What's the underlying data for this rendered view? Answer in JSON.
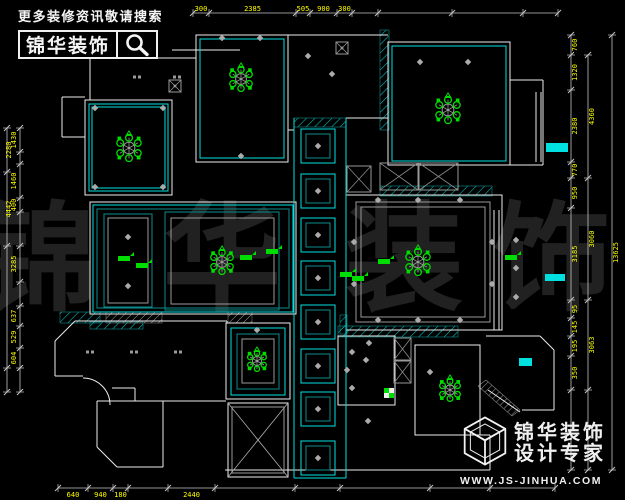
{
  "branding": {
    "top": {
      "tagline": "更多装修资讯敬请搜索",
      "logo_text": "锦华装饰",
      "icon": "magnifier-icon"
    },
    "bottom": {
      "line1": "锦华装饰",
      "line2": "设计专家",
      "url": "WWW.JS-JINHUA.COM",
      "icon": "cube-logo-icon"
    }
  },
  "watermark": {
    "chars": [
      "锦",
      "华",
      "装",
      "饰"
    ],
    "xs": [
      38,
      222,
      404,
      552
    ],
    "y": 300,
    "size": 118,
    "color": "#212121"
  },
  "plan": {
    "colors": {
      "wall": "#EDEDED",
      "cyan": "#00E0E0",
      "teal": "#0E8B8B",
      "gray": "#9A9A9A",
      "green": "#00DD00",
      "yellow": "#FFFF00",
      "dim": "#C6C6C6"
    },
    "walls": {
      "rects": [
        [
          85,
          100,
          87,
          95
        ],
        [
          196,
          35,
          92,
          127
        ],
        [
          388,
          42,
          122,
          123
        ],
        [
          90,
          202,
          206,
          112
        ],
        [
          346,
          195,
          156,
          135
        ],
        [
          226,
          323,
          64,
          76
        ],
        [
          415,
          345,
          65,
          90
        ],
        [
          338,
          336,
          57,
          69
        ]
      ],
      "lines": [
        [
          62,
          97,
          85,
          97
        ],
        [
          62,
          97,
          62,
          137
        ],
        [
          62,
          137,
          85,
          137
        ],
        [
          90,
          58,
          196,
          58
        ],
        [
          90,
          58,
          90,
          100
        ],
        [
          172,
          50,
          240,
          50
        ],
        [
          288,
          35,
          388,
          35
        ],
        [
          510,
          80,
          543,
          80
        ],
        [
          543,
          80,
          543,
          165
        ],
        [
          510,
          165,
          543,
          165
        ],
        [
          536,
          92,
          536,
          162
        ],
        [
          541,
          92,
          541,
          162
        ],
        [
          494,
          210,
          494,
          330
        ],
        [
          499,
          210,
          499,
          330
        ],
        [
          486,
          336,
          540,
          336
        ],
        [
          540,
          336,
          554,
          350
        ],
        [
          554,
          350,
          554,
          410
        ],
        [
          554,
          410,
          522,
          410
        ],
        [
          488,
          390,
          520,
          412
        ],
        [
          225,
          470,
          418,
          470
        ],
        [
          415,
          435,
          490,
          435
        ],
        [
          490,
          435,
          490,
          470
        ],
        [
          418,
          470,
          490,
          470
        ],
        [
          75,
          321,
          227,
          321
        ],
        [
          75,
          321,
          55,
          341
        ],
        [
          55,
          341,
          55,
          376
        ],
        [
          55,
          376,
          83,
          376
        ],
        [
          112,
          388,
          135,
          388
        ],
        [
          135,
          388,
          135,
          401
        ],
        [
          135,
          401,
          226,
          401
        ],
        [
          227,
          321,
          227,
          323
        ],
        [
          97,
          401,
          163,
          401
        ],
        [
          163,
          401,
          163,
          467
        ],
        [
          163,
          467,
          117,
          467
        ],
        [
          117,
          467,
          97,
          447
        ],
        [
          97,
          447,
          97,
          401
        ],
        [
          346,
          118,
          388,
          118
        ],
        [
          288,
          130,
          294,
          130
        ]
      ]
    },
    "arcs": [
      "M83,378 A27,27 0 0 1 110,405"
    ],
    "cyanLines": [
      [
        294,
        118,
        294,
        478
      ],
      [
        346,
        118,
        346,
        478
      ],
      [
        294,
        478,
        346,
        478
      ]
    ],
    "cyanRects": [
      [
        89,
        104,
        79,
        87
      ],
      [
        92,
        107,
        73,
        81
      ],
      [
        200,
        39,
        84,
        119
      ],
      [
        392,
        46,
        114,
        115
      ],
      [
        93,
        205,
        200,
        107
      ],
      [
        231,
        328,
        54,
        67
      ]
    ],
    "tealRects": [
      [
        97,
        209,
        192,
        99
      ],
      [
        104,
        214,
        48,
        93
      ],
      [
        165,
        212,
        114,
        98
      ],
      [
        237,
        334,
        42,
        55
      ]
    ],
    "grayRects": [
      [
        108,
        218,
        40,
        85
      ],
      [
        171,
        218,
        103,
        86
      ],
      [
        356,
        202,
        134,
        120
      ],
      [
        361,
        207,
        124,
        110
      ],
      [
        242,
        339,
        32,
        44
      ],
      [
        232,
        407,
        52,
        66
      ]
    ],
    "hatchesCyan": [
      [
        294,
        118,
        52,
        9
      ],
      [
        380,
        30,
        9,
        100
      ],
      [
        380,
        186,
        112,
        10
      ],
      [
        90,
        322,
        53,
        7
      ],
      [
        60,
        312,
        40,
        11
      ],
      [
        338,
        326,
        120,
        11
      ],
      [
        340,
        315,
        7,
        19
      ]
    ],
    "hatchesWhite": [
      [
        106,
        312,
        56,
        11
      ],
      [
        228,
        312,
        24,
        11
      ]
    ],
    "hatchBand": "M486,380 L520,410 L512,416 L478,386 Z",
    "xboxes": [
      [
        228,
        403,
        60,
        74,
        "#EEEEEE",
        "#ABABAB"
      ],
      [
        380,
        163,
        38,
        27,
        "#999999",
        "#8A8A8A"
      ],
      [
        419,
        163,
        39,
        27,
        "#999999",
        "#8A8A8A"
      ],
      [
        394,
        338,
        17,
        22,
        "#999999",
        "#8A8A8A"
      ],
      [
        394,
        361,
        17,
        22,
        "#999999",
        "#8A8A8A"
      ],
      [
        347,
        166,
        24,
        26,
        "#999999",
        "#8A8A8A"
      ]
    ],
    "coffers": {
      "x": 301,
      "size": 34,
      "ys": [
        129,
        174,
        218,
        261,
        305,
        349,
        392,
        441
      ]
    },
    "chandeliers": [
      [
        129,
        148,
        13
      ],
      [
        241,
        79,
        12
      ],
      [
        448,
        110,
        13
      ],
      [
        222,
        262,
        12
      ],
      [
        418,
        262,
        13
      ],
      [
        257,
        361,
        10
      ],
      [
        450,
        390,
        11
      ]
    ],
    "diamonds": [
      [
        222,
        38
      ],
      [
        260,
        38
      ],
      [
        241,
        156
      ],
      [
        420,
        62
      ],
      [
        468,
        62
      ],
      [
        308,
        56
      ],
      [
        332,
        74
      ],
      [
        95,
        108
      ],
      [
        163,
        108
      ],
      [
        95,
        187
      ],
      [
        163,
        187
      ],
      [
        128,
        237
      ],
      [
        128,
        286
      ],
      [
        378,
        200
      ],
      [
        418,
        200
      ],
      [
        460,
        200
      ],
      [
        378,
        320
      ],
      [
        418,
        320
      ],
      [
        460,
        320
      ],
      [
        354,
        242
      ],
      [
        354,
        284
      ],
      [
        492,
        242
      ],
      [
        492,
        284
      ],
      [
        516,
        240
      ],
      [
        516,
        268
      ],
      [
        516,
        297
      ],
      [
        257,
        330
      ],
      [
        352,
        352
      ],
      [
        347,
        370
      ],
      [
        352,
        388
      ],
      [
        366,
        360
      ],
      [
        369,
        343
      ],
      [
        430,
        372
      ],
      [
        368,
        421
      ]
    ],
    "dotPairs": [
      [
        137,
        77
      ],
      [
        177,
        77
      ],
      [
        90,
        352
      ],
      [
        134,
        352
      ],
      [
        178,
        352
      ]
    ],
    "fans": [
      [
        175,
        86
      ],
      [
        342,
        48
      ]
    ],
    "greenTags": [
      [
        118,
        256
      ],
      [
        136,
        263
      ],
      [
        240,
        255
      ],
      [
        266,
        249
      ],
      [
        352,
        276
      ],
      [
        378,
        259
      ],
      [
        505,
        255
      ],
      [
        340,
        272
      ]
    ],
    "checker": [
      384,
      388
    ],
    "cyanBars": [
      [
        546,
        143,
        22,
        9
      ],
      [
        545,
        274,
        20,
        7
      ],
      [
        519,
        358,
        13,
        8
      ]
    ],
    "dims": {
      "chains": [
        {
          "axis": "h",
          "pos": 13,
          "from": 193,
          "to": 558,
          "ticks": [
            193,
            209,
            296,
            310,
            337,
            352,
            378,
            452,
            523,
            558
          ],
          "labels": [
            "300",
            "2385",
            "505",
            "900",
            "300",
            "",
            "",
            "",
            ""
          ],
          "off": -2
        },
        {
          "axis": "h",
          "pos": 488,
          "from": 58,
          "to": 555,
          "ticks": [
            58,
            88,
            113,
            128,
            168,
            215,
            295,
            340,
            430,
            490,
            555
          ],
          "labels": [
            "640",
            "940",
            "180",
            "",
            "2440",
            "",
            "",
            "",
            "",
            ""
          ],
          "off": 9
        },
        {
          "axis": "v",
          "pos": 20,
          "from": 128,
          "to": 392,
          "ticks": [
            128,
            152,
            164,
            198,
            212,
            246,
            282,
            306,
            326,
            348,
            368,
            392
          ],
          "labels": [
            "1430",
            "",
            "1460",
            "400",
            "",
            "3285",
            "",
            "637",
            "529",
            "604",
            ""
          ],
          "off": -4
        },
        {
          "axis": "v",
          "pos": 7,
          "from": 128,
          "to": 392,
          "ticks": [
            128,
            172,
            246,
            368,
            392
          ],
          "labels": [
            "2280",
            "4442",
            "",
            ""
          ],
          "off": 4
        },
        {
          "axis": "v",
          "pos": 571,
          "from": 35,
          "to": 470,
          "ticks": [
            35,
            55,
            90,
            162,
            178,
            208,
            300,
            318,
            336,
            356,
            390,
            470
          ],
          "labels": [
            "760",
            "1320",
            "2380",
            "770",
            "950",
            "3185",
            "95",
            "145",
            "195",
            "350",
            ""
          ],
          "off": 6
        },
        {
          "axis": "v",
          "pos": 588,
          "from": 55,
          "to": 470,
          "ticks": [
            55,
            178,
            300,
            390,
            470
          ],
          "labels": [
            "4360",
            "3060",
            "3063",
            ""
          ],
          "off": 6
        },
        {
          "axis": "v",
          "pos": 612,
          "from": 35,
          "to": 470,
          "ticks": [
            35,
            470
          ],
          "labels": [
            "13625"
          ],
          "off": 6
        }
      ]
    }
  }
}
